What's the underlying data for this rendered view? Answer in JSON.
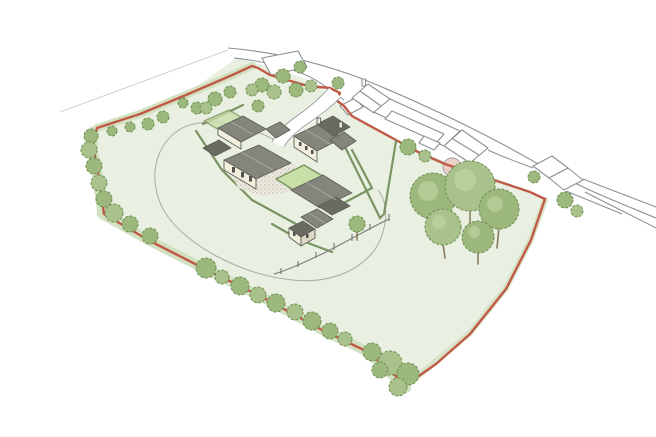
{
  "canvas": {
    "width": 656,
    "height": 437,
    "background": "#ffffff"
  },
  "colors": {
    "field_green": "#e9efe1",
    "field_edge_green": "#d2e1c1",
    "lawn_green": "#c9dfa8",
    "tree_green": "#9cb87d",
    "tree_green_alt": "#a9c28c",
    "tree_green_light": "#c6d9a9",
    "tree_green_dark": "#6e8f52",
    "hedge_olive": "#7b9463",
    "boundary_red": "#c05a46",
    "roof_grey": "#84867e",
    "roof_grey_dark": "#696b63",
    "roof_ridge": "#aaaca2",
    "wall_cream": "#f2efdf",
    "wall_shadow": "#ddd9c6",
    "window_dark": "#4f524d",
    "outline_grey": "#8b9094",
    "sketch_grey": "#7b827e",
    "courtyard_fill": "#edebdf",
    "stipple_grey": "#b3b0a0",
    "trunk_brown": "#8a7a60",
    "feature_pink": "#ecc9c0"
  }
}
